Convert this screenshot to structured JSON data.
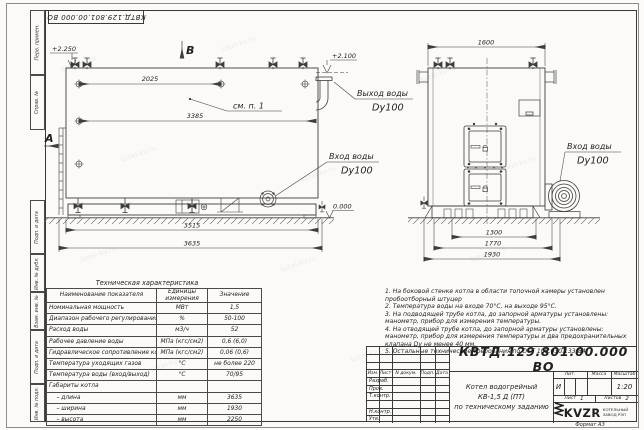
{
  "watermark": "kotel-kv.ru",
  "corner_stamp": "КВТД.129.801.00.000  ВО",
  "margin_labels": {
    "perv_primen": "Перв. примен.",
    "sprav_no": "Справ. №",
    "podp_data_1": "Подп. и дата",
    "inv_dubl": "Инв. № дубл.",
    "vzam_inv": "Взам. инв. №",
    "podp_data_2": "Подп. и дата",
    "inv_podl": "Инв. № подл."
  },
  "side_view": {
    "view_b": "В",
    "view_a": "А",
    "level_top": "+2.250",
    "level_zero": "0.000",
    "callout": "см. п. 1",
    "dim_2025": "2025",
    "dim_3385": "3385",
    "dim_3515": "3515",
    "dim_3635": "3635",
    "outlet_line1": "Выход воды",
    "outlet_line2": "Dy100",
    "inlet_line1": "Вход воды",
    "inlet_line2": "Dy100"
  },
  "front_view": {
    "level_top": "+2.100",
    "dim_1600": "1600",
    "dim_1300": "1300",
    "dim_1770": "1770",
    "dim_1930": "1930",
    "inlet_line1": "Вход воды",
    "inlet_line2": "Dy100"
  },
  "spec_table": {
    "title": "Техническая характеристика",
    "col_name": "Наименование показателя",
    "col_units_1": "Единицы",
    "col_units_2": "измерения",
    "col_value": "Значение",
    "rows": [
      [
        "Номинальная мощность",
        "МВт",
        "1,5"
      ],
      [
        "Диапазон рабочего регулирования",
        "%",
        "50-100"
      ],
      [
        "Расход воды",
        "м3/ч",
        "52"
      ],
      [
        "Рабочее давление воды",
        "МПа (кгс/см2)",
        "0,6 (6,0)"
      ],
      [
        "Гидравлическое сопротивление котла",
        "МПа (кгс/см2)",
        "0,06 (0,6)"
      ],
      [
        "Температура уходящих газов",
        "°С",
        "не более 220"
      ],
      [
        "Температура воды (вход/выход)",
        "°С",
        "70/95"
      ],
      [
        "Габариты котла",
        "",
        ""
      ],
      [
        "    – длина",
        "мм",
        "3635"
      ],
      [
        "    – ширина",
        "мм",
        "1930"
      ],
      [
        "    – высота",
        "мм",
        "2250"
      ]
    ]
  },
  "notes": [
    "1.  На боковой стенке котла в области топочной камеры установлен пробоотборный штуцер",
    "2.  Температура воды на входе 70°С, на выходе 95°С.",
    "3.  На подводящей трубе котла, до запорной арматуры установлены: манометр, прибор для измерения температуры.",
    "4.  На отводящей трубе котла, до запорной арматуры установлены: манометр, прибор для измерения температуры и два предохранительных клапана Dу не менее 40 мм.",
    "5.  Остальные технические требования по ОСТ 108.030.133-84."
  ],
  "title_block": {
    "doc_number": "КВТД.129.801.00.000  ВО",
    "name_line1": "Котел водогрейный",
    "name_line2": "КВ-1,5 Д (ПТ)",
    "name_line3": "по техническому заданию",
    "col_izm": "Изм.",
    "col_list": "Лист",
    "col_ndoc": "N докум.",
    "col_podp": "Подп.",
    "col_data": "Дата",
    "row_razrab": "Разраб.",
    "row_prov": "Пров.",
    "row_tkontr": "Т.контр.",
    "row_nkontr": "Н.контр.",
    "row_utv": "Утв.",
    "lit_header": "Лит.",
    "mass_header": "Масса",
    "scale_header": "Масштаб",
    "lit_value": "И",
    "scale_value": "1:20",
    "sheet_label": "Лист",
    "sheet_value": "1",
    "sheets_label": "Листов",
    "sheets_value": "2"
  },
  "logo": {
    "abbr": "KVZR",
    "text_line1": "КОТЕЛЬНЫЙ",
    "text_line2": "ЗАВОД РЭП"
  },
  "format_note": "Формат  А3"
}
